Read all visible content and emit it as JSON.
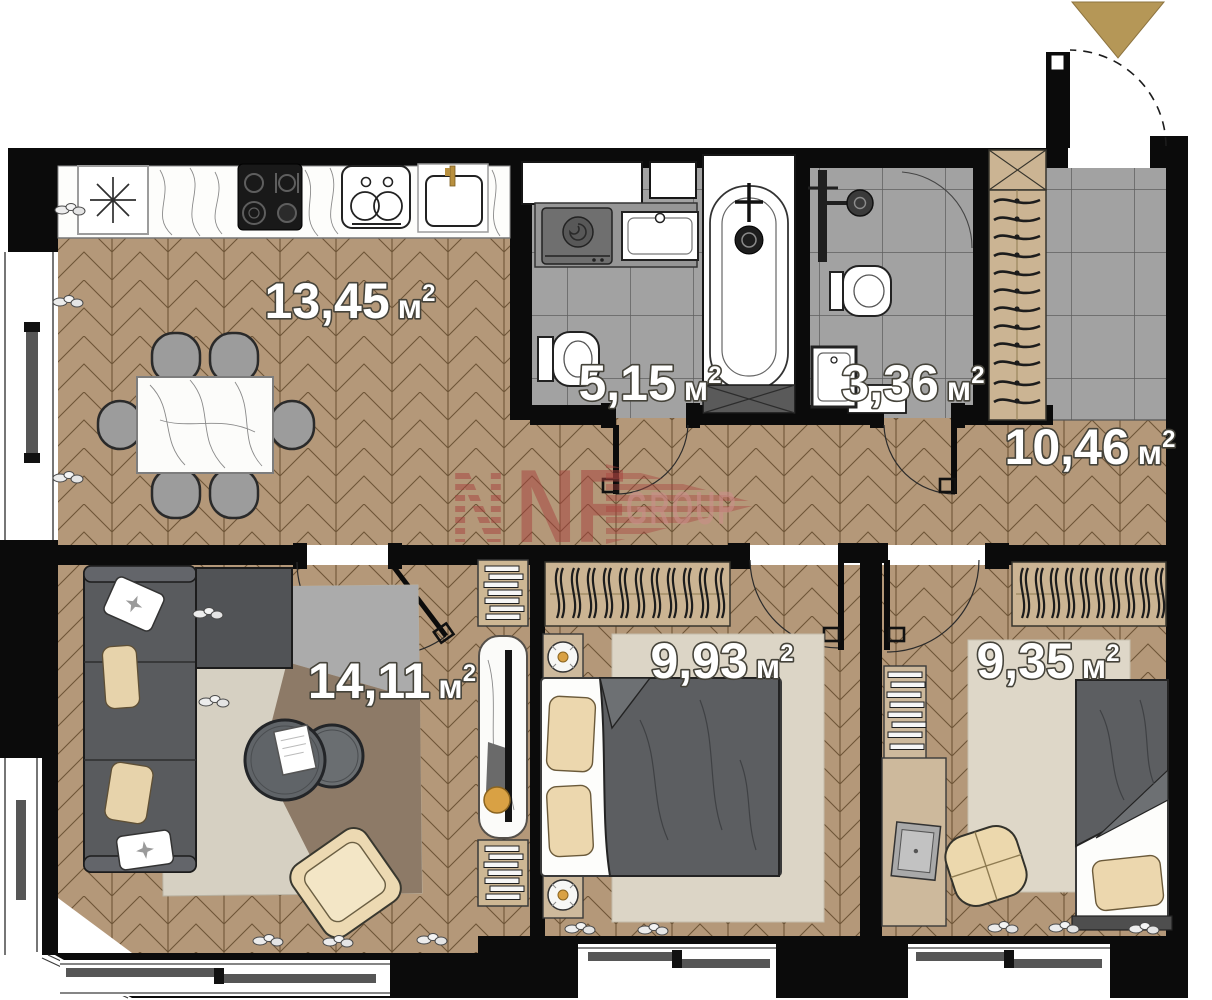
{
  "floorplan": {
    "brand": {
      "n": "N",
      "name": "NF",
      "suffix": "GROUP",
      "color": "#a8423e",
      "suffix_color": "#c98f88"
    },
    "entrance_marker_color": "#b59757",
    "rooms": {
      "kitchen_living": {
        "value": "13,45",
        "unit": "м",
        "sup": "2"
      },
      "bathroom": {
        "value": "5,15",
        "unit": "м",
        "sup": "2"
      },
      "wc": {
        "value": "3,36",
        "unit": "м",
        "sup": "2"
      },
      "hallway": {
        "value": "10,46",
        "unit": "м",
        "sup": "2"
      },
      "living_room": {
        "value": "14,11",
        "unit": "м",
        "sup": "2"
      },
      "bedroom_1": {
        "value": "9,93",
        "unit": "м",
        "sup": "2"
      },
      "bedroom_2": {
        "value": "9,35",
        "unit": "м",
        "sup": "2"
      }
    }
  }
}
